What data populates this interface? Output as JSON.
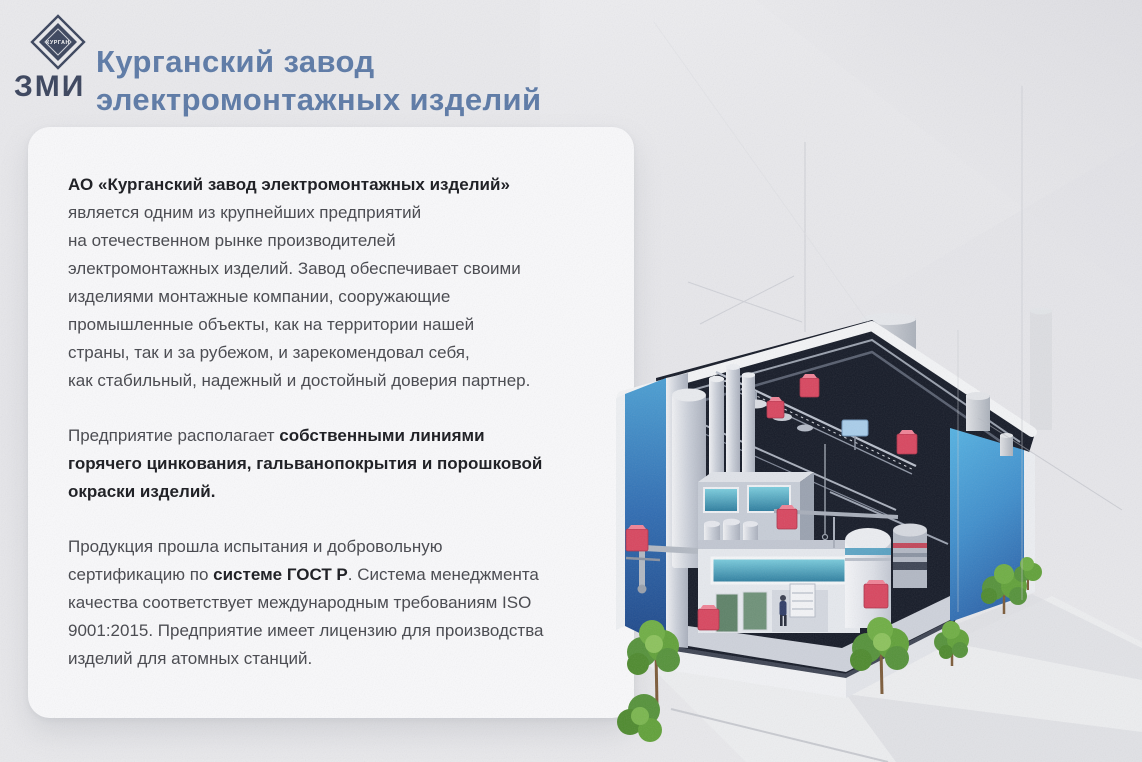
{
  "header": {
    "title": "Курганский завод\nэлектромонтажных изделий",
    "title_color": "#5b79a6",
    "logo": {
      "band_text": "КУРГАН",
      "bottom_text": "ЗМИ",
      "color": "#39435c"
    }
  },
  "card": {
    "paragraphs": [
      {
        "segments": [
          {
            "bold": true,
            "text": "АО «Курганский завод электромонтажных изделий»\n"
          },
          {
            "bold": false,
            "text": "является одним из крупнейших предприятий\nна отечественном рынке производителей\nэлектромонтажных изделий. Завод обеспечивает своими\nизделиями монтажные компании, сооружающие\nпромышленные объекты, как на территории нашей\nстраны, так и за рубежом, и зарекомендовал себя,\nкак стабильный, надежный и достойный доверия партнер."
          }
        ]
      },
      {
        "segments": [
          {
            "bold": false,
            "text": "Предприятие располагает "
          },
          {
            "bold": true,
            "text": "собственными линиями\nгорячего цинкования, гальванопокрытия и порошковой\nокраски изделий."
          }
        ]
      },
      {
        "segments": [
          {
            "bold": false,
            "text": "Продукция прошла испытания и добровольную\nсертификацию по "
          },
          {
            "bold": true,
            "text": "системе ГОСТ Р"
          },
          {
            "bold": false,
            "text": ". Система менеджмента\nкачества соответствует международным требованиям ISO\n9001:2015. Предприятие имеет лицензию для производства\nизделий для атомных станций."
          }
        ]
      }
    ]
  },
  "illustration": {
    "type": "isometric-factory-cutaway",
    "marker_count": 7,
    "tree_count": 5,
    "colors": {
      "wall_blue_light": "#55b2e2",
      "wall_blue_dark": "#1d4688",
      "interior_dark": "#151a27",
      "marker_red": "#d8465f",
      "tree_green": "#61a139",
      "metal_silver": "#c9ced8"
    }
  }
}
